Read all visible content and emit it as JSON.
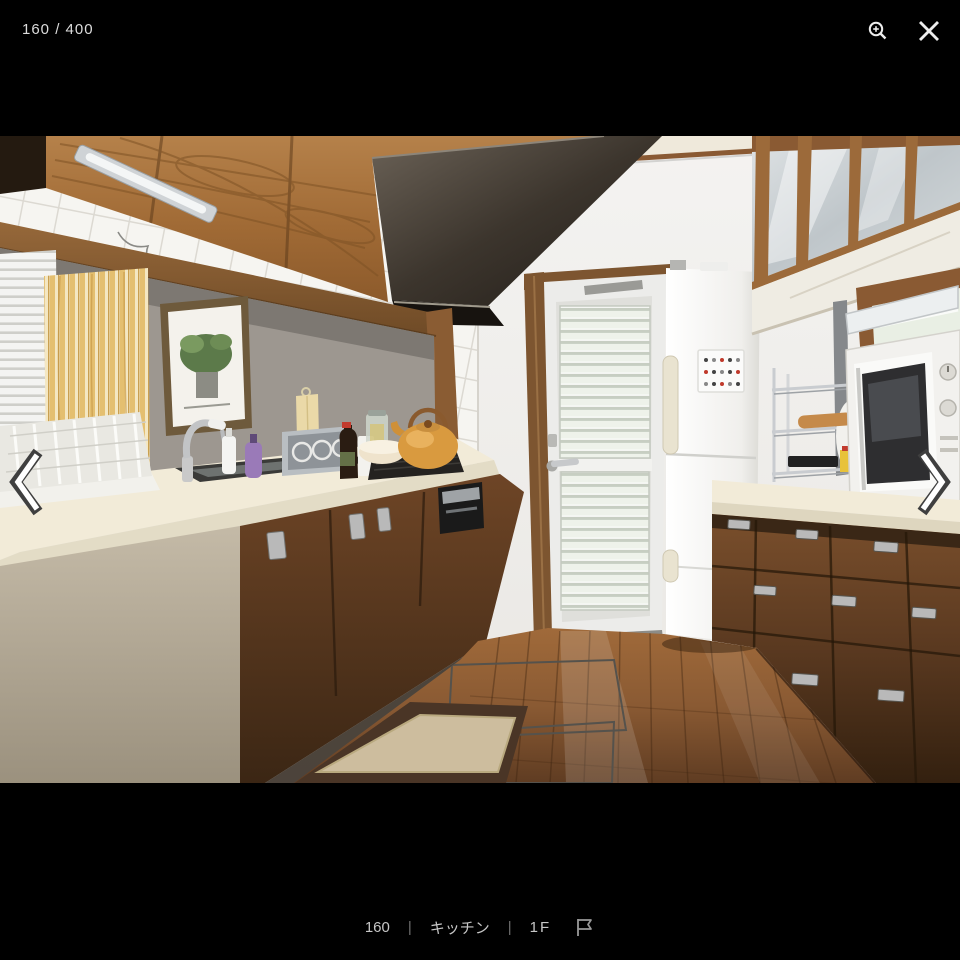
{
  "viewer": {
    "position_indicator": "160 / 400",
    "caption": {
      "photo_number": "160",
      "separator": "|",
      "room_label": "キッチン",
      "floor_label": "1F"
    },
    "icons": {
      "zoom_in": "magnifier-plus",
      "close": "x-cross",
      "previous": "chevron-left",
      "next": "chevron-right",
      "flag": "flag-outline"
    },
    "colors": {
      "background": "#000000",
      "ui_text": "#dcdcdc",
      "caption_text": "#c6c6c6",
      "separator": "#6f6f6f",
      "icon": "#ededed"
    }
  },
  "photo": {
    "description": "Narrow galley kitchen: oak upper cabinets and dark range hood on the left over a tiled wall, sink counter with dish rack and kettle on gas stove, white louvered back door in the center, white refrigerator beside it, glass-front upper cabinet, window, wire rack and microwave over dark wood base cabinets on the right, glossy wood floor with a beige mat",
    "colors": {
      "upper_cabinet_wood": "#a9713c",
      "base_cabinet_wood": "#53351e",
      "counter": "#f2ebd8",
      "tile": "#f6f5f1",
      "floor": "#8a5a33",
      "mat": "#cdbd9e",
      "mat_border": "#4a3526",
      "kettle": "#d99a3f",
      "curtain": "#e8c87a",
      "door_glass": "#eef2ea"
    }
  }
}
